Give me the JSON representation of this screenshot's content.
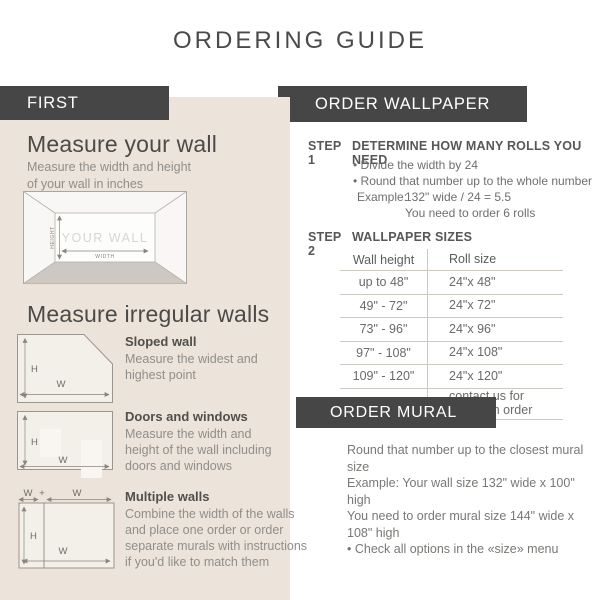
{
  "page": {
    "title": "ORDERING GUIDE"
  },
  "colors": {
    "header_box": "#464646",
    "panel_beige": "#ece3da",
    "text_dark": "#4a4a4a",
    "text_gray": "#908e8a"
  },
  "left": {
    "header": "FIRST",
    "measure_wall": {
      "title": "Measure your wall",
      "subtitle": "Measure the width and height\nof your wall in inches",
      "diagram": {
        "wall_label": "YOUR WALL",
        "height_label": "HEIGHT",
        "width_label": "WIDTH"
      }
    },
    "irregular": {
      "title": "Measure irregular walls",
      "labels": {
        "h": "H",
        "w": "W",
        "plus": "+"
      },
      "sections": [
        {
          "name": "Sloped wall",
          "desc": "Measure the widest and\nhighest point"
        },
        {
          "name": "Doors and windows",
          "desc": "Measure the width and\nheight of the wall including\ndoors and windows"
        },
        {
          "name": "Multiple walls",
          "desc": "Combine the width of the walls\nand place one order or order\nseparate murals with instructions\nif you'd like to match them"
        }
      ]
    }
  },
  "wallpaper": {
    "header": "ORDER WALLPAPER",
    "step1": {
      "label": "STEP 1",
      "title": "DETERMINE HOW MANY ROLLS YOU NEED",
      "bullets": [
        "• Divide the width by 24",
        "• Round that number up to the whole number"
      ],
      "example_label": "Example:",
      "example_value": "132\" wide / 24 = 5.5",
      "example_result": "You need to order 6 rolls"
    },
    "step2": {
      "label": "STEP 2",
      "title": "WALLPAPER SIZES",
      "table": {
        "columns": [
          "Wall height",
          "Roll size"
        ],
        "rows": [
          [
            "up to 48\"",
            "24\"x 48\""
          ],
          [
            "49\" - 72\"",
            "24\"x 72\""
          ],
          [
            "73\" - 96\"",
            "24\"x 96\""
          ],
          [
            "97\" - 108\"",
            "24\"x 108\""
          ],
          [
            "109\" - 120\"",
            "24\"x 120\""
          ],
          [
            "more than 120\"",
            "contact us for\na custom order"
          ]
        ]
      }
    }
  },
  "mural": {
    "header": "ORDER MURAL",
    "lines": [
      "Round that number up to the closest mural size",
      "Example: Your wall size 132\" wide x 100\" high",
      "You need to order mural size 144\" wide x 108\" high",
      "• Check all options in the «size» menu"
    ]
  }
}
